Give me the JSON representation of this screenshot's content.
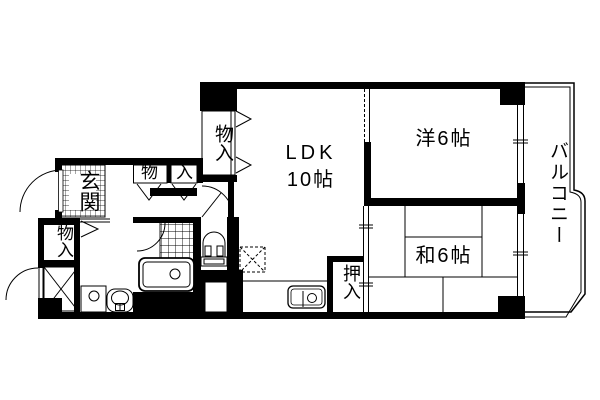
{
  "plan": {
    "genkan": "玄関",
    "storage_top": "物入",
    "storage_left": "物入",
    "storage_mono": "物",
    "storage_iri": "入",
    "ldk_line1": "LDK",
    "ldk_line2": "10帖",
    "western_room": "洋6帖",
    "japanese_room": "和6帖",
    "oshiire": "押入",
    "balcony": "バルコニー"
  },
  "colors": {
    "line": "#000000",
    "background": "#ffffff"
  }
}
